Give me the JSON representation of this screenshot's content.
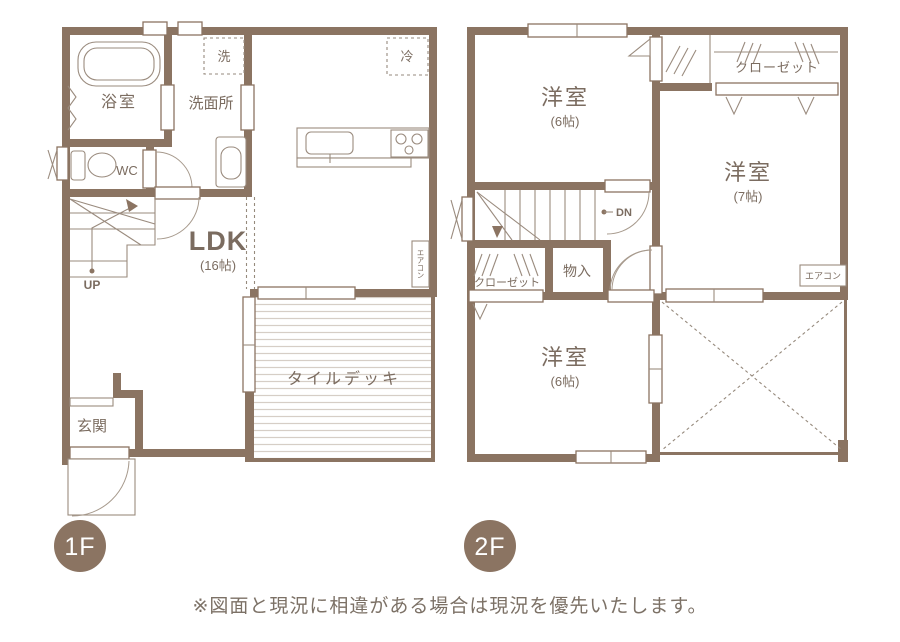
{
  "colors": {
    "wall": "#8b7462",
    "line": "#9a8b7e",
    "text": "#7b6c60",
    "badge": "#8b7462",
    "deck_stripe": "#d6cec6"
  },
  "floor1": {
    "badge": "1F",
    "rooms": {
      "bathroom": "浴室",
      "washroom": "洗面所",
      "wc": "WC",
      "ldk": "LDK",
      "ldk_size": "(16帖)",
      "entrance": "玄関",
      "tile_deck": "タイルデッキ"
    },
    "labels": {
      "washer": "洗",
      "fridge": "冷",
      "up": "UP",
      "aircon": "エアコン"
    }
  },
  "floor2": {
    "badge": "2F",
    "rooms": {
      "bedroom_top": "洋室",
      "bedroom_top_size": "(6帖)",
      "bedroom_right": "洋室",
      "bedroom_right_size": "(7帖)",
      "bedroom_bottom": "洋室",
      "bedroom_bottom_size": "(6帖)",
      "closet_top": "クローゼット",
      "closet_mid": "クローゼット",
      "storage": "物入"
    },
    "labels": {
      "down": "DN",
      "aircon": "エアコン"
    }
  },
  "footer": {
    "note": "※図面と現況に相違がある場合は現況を優先いたします。"
  }
}
